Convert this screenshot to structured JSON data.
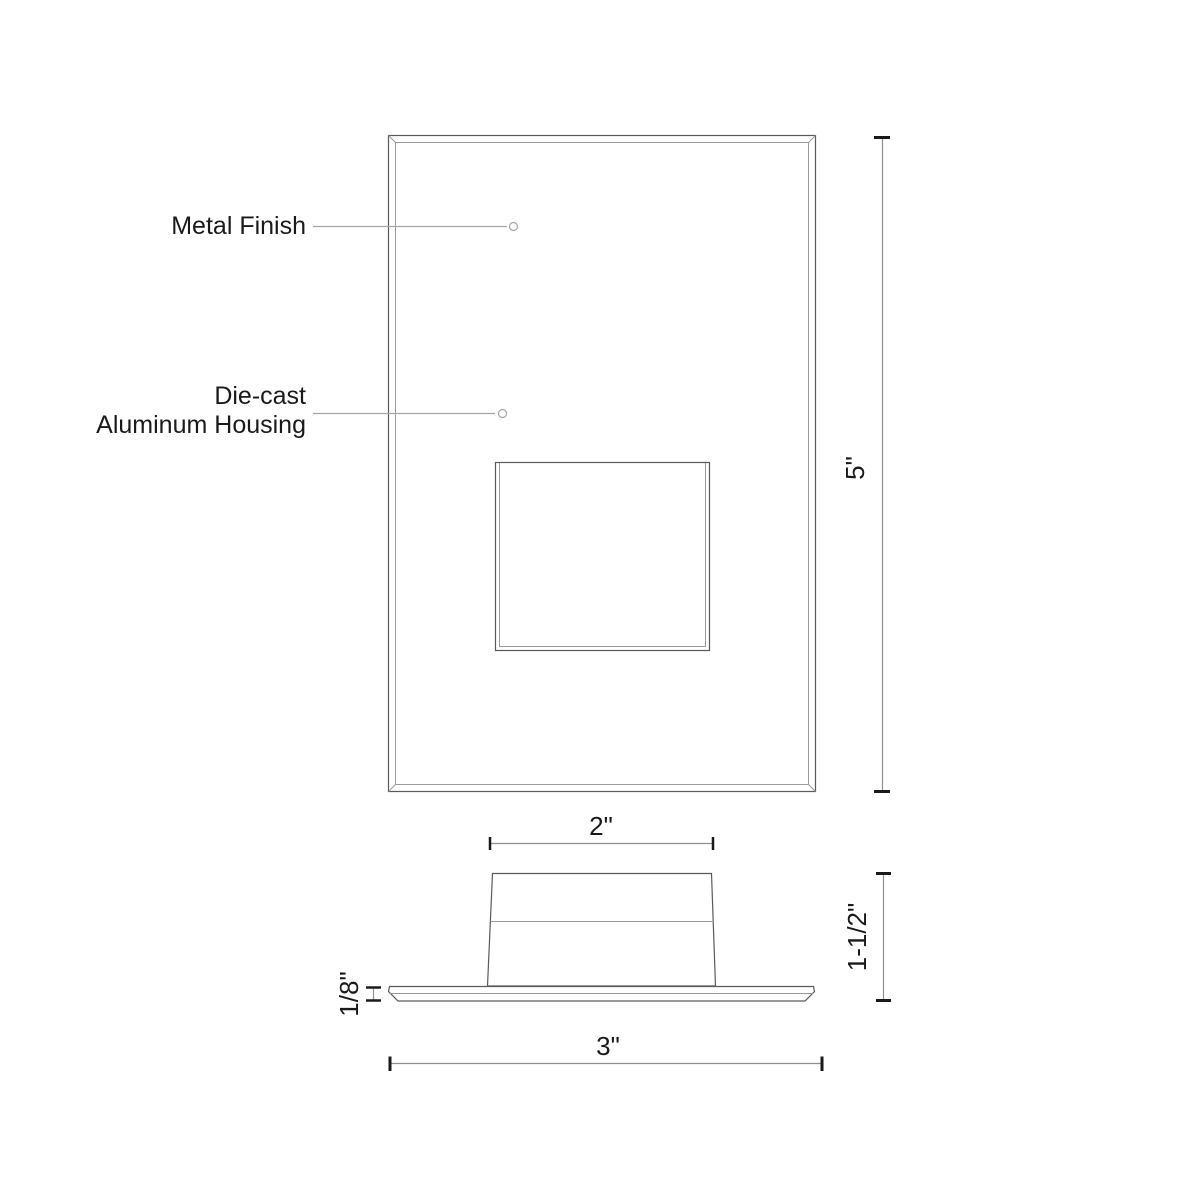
{
  "diagram": {
    "callouts": {
      "metal_finish": "Metal Finish",
      "housing_line1": "Die-cast",
      "housing_line2": "Aluminum Housing"
    },
    "dimensions": {
      "overall_height": "5\"",
      "housing_face_width": "2\"",
      "overall_depth": "1-1/2\"",
      "plate_thickness": "1/8\"",
      "plate_width": "3\""
    },
    "colors": {
      "outline": "#5a5a5a",
      "thin_line": "#9a9a9a",
      "leader_line": "#a6a6a6",
      "dimension_line": "#8f8f8f",
      "tick": "#1a1a1a",
      "text": "#1a1a1a",
      "background": "#ffffff"
    }
  }
}
